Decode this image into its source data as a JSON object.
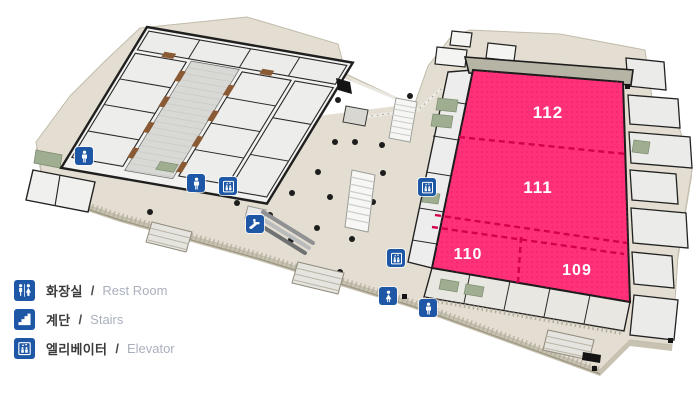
{
  "halls": [
    {
      "id": "112",
      "label": "112"
    },
    {
      "id": "111",
      "label": "111"
    },
    {
      "id": "110",
      "label": "110"
    },
    {
      "id": "109",
      "label": "109"
    }
  ],
  "legend": {
    "separator": "/",
    "items": [
      {
        "icon": "restroom-icon",
        "ko": "화장실",
        "en": "Rest Room"
      },
      {
        "icon": "stairs-icon",
        "ko": "계단",
        "en": "Stairs"
      },
      {
        "icon": "elevator-icon",
        "ko": "엘리베이터",
        "en": "Elevator"
      }
    ]
  },
  "markers": [
    {
      "icon": "restroom-icon",
      "glyph": "man",
      "x": 84,
      "y": 156
    },
    {
      "icon": "restroom-icon",
      "glyph": "man",
      "x": 196,
      "y": 183
    },
    {
      "icon": "elevator-icon",
      "glyph": "elevator",
      "x": 228,
      "y": 186
    },
    {
      "icon": "escalator-icon",
      "glyph": "escalator",
      "x": 255,
      "y": 224
    },
    {
      "icon": "elevator-icon",
      "glyph": "elevator",
      "x": 427,
      "y": 187
    },
    {
      "icon": "elevator-icon",
      "glyph": "elevator",
      "x": 396,
      "y": 258
    },
    {
      "icon": "restroom-icon",
      "glyph": "woman",
      "x": 388,
      "y": 296
    },
    {
      "icon": "restroom-icon",
      "glyph": "man",
      "x": 428,
      "y": 308
    }
  ],
  "colors": {
    "highlight": "#fe3179",
    "highlight_dot": "#e01261",
    "highlight_divider": "#d4004d",
    "icon_blue": "#1e57a5",
    "platform": "#e3ded1",
    "legend_ko": "#3b3b3b",
    "legend_en": "#a9b0bc"
  }
}
